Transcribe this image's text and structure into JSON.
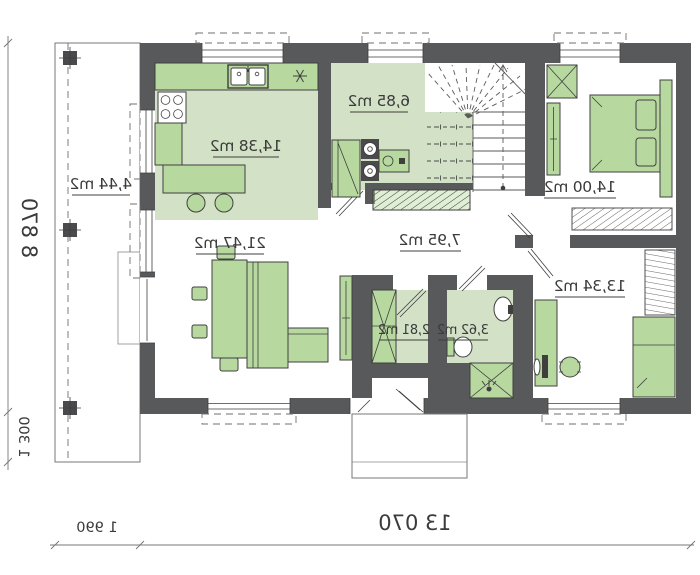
{
  "plan": {
    "type": "floor-plan",
    "mirrored": true,
    "rooms": [
      {
        "id": "kitchen",
        "area_label": "14,38 m2"
      },
      {
        "id": "utility",
        "area_label": "6,85 m2"
      },
      {
        "id": "terrace",
        "area_label": "4,44 m2"
      },
      {
        "id": "living-room",
        "area_label": "21,47 m2"
      },
      {
        "id": "hall",
        "area_label": "7,95 m2"
      },
      {
        "id": "bedroom",
        "area_label": "14,00 m2"
      },
      {
        "id": "room",
        "area_label": "13,34 m2"
      },
      {
        "id": "bathroom",
        "area_label": "3,62 m2"
      },
      {
        "id": "closet",
        "area_label": "2,81 m2"
      }
    ],
    "dimensions": {
      "total_height": "8 870",
      "porch_height": "1 300",
      "terrace_width": "1 990",
      "total_width": "13 070"
    },
    "colors": {
      "wall": "#58595b",
      "furniture": "#b7d9a0",
      "room_fill": "#d3e1c7",
      "line": "#3f3f3e"
    }
  }
}
